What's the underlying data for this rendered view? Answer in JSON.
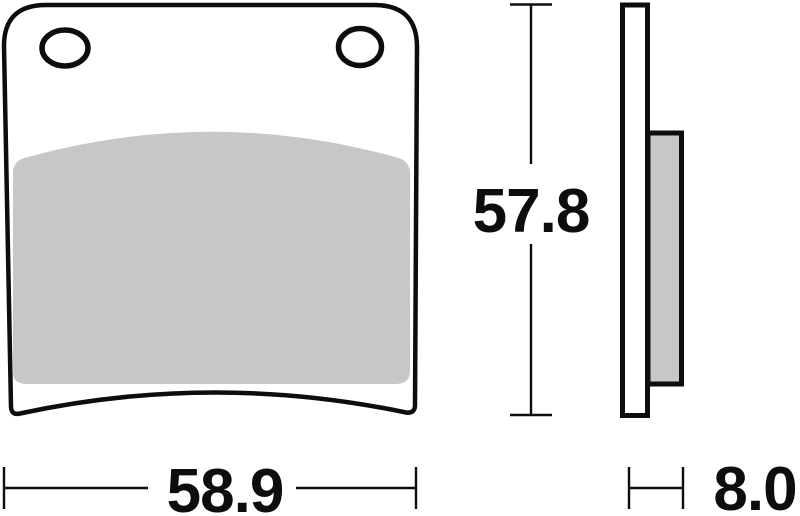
{
  "drawing": {
    "kind": "technical-drawing",
    "part": "brake-pad",
    "views": {
      "front": {
        "mounting_holes": 2
      },
      "side": {
        "layers": [
          "backing-plate",
          "friction-material"
        ]
      }
    }
  },
  "dimensions": {
    "width_mm": "58.9",
    "height_mm": "57.8",
    "thickness_mm": "8.0"
  },
  "colors": {
    "outline": "#0d0d0d",
    "friction_material": "#c7c7c7",
    "background": "#ffffff"
  }
}
